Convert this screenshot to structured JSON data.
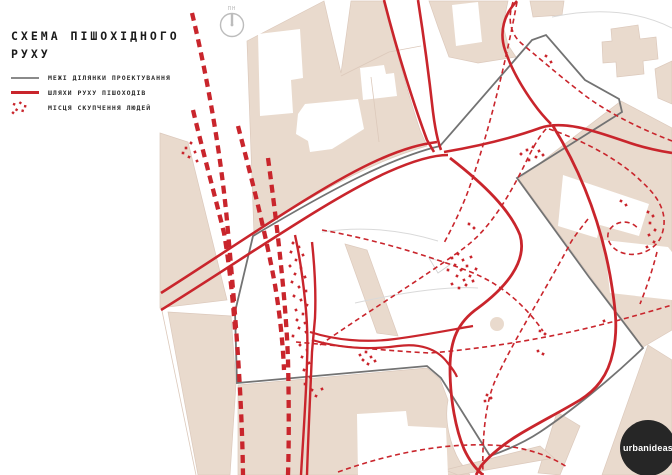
{
  "title": {
    "line1": "СХЕМА ПІШОХІДНОГО",
    "line2": "РУХУ"
  },
  "legend": {
    "items": [
      {
        "id": "site-boundary",
        "label": "МЕЖІ ДІЛЯНКИ ПРОЕКТУВАННЯ"
      },
      {
        "id": "pedestrian-routes",
        "label": "ШЛЯХИ РУХУ ПІШОХОДІВ"
      },
      {
        "id": "crowd-spots",
        "label": "МІСЦЯ СКУПЧЕННЯ ЛЮДЕЙ"
      }
    ]
  },
  "compass": {
    "label": "ПН"
  },
  "logo": {
    "text": "urbanideas"
  },
  "colors": {
    "route_red": "#c9252c",
    "boundary_gray": "#737373",
    "block_beige": "#e9dacd",
    "logo_black": "#262626"
  }
}
